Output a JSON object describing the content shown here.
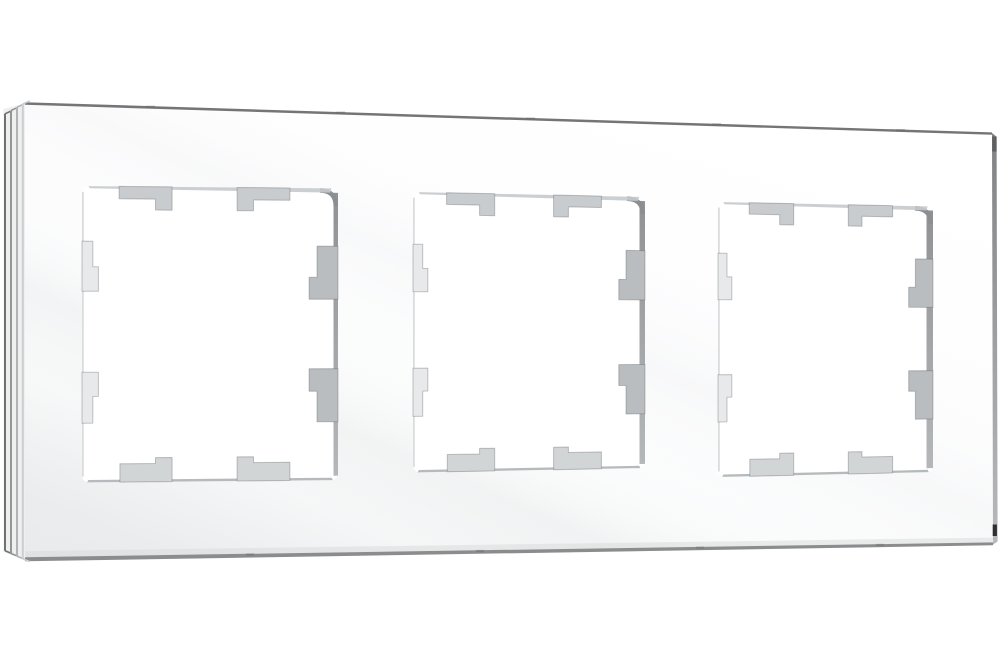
{
  "page": {
    "background": "#ffffff"
  },
  "product": {
    "name": "triple-glass-wall-frame",
    "description": "White glass three-gang wall frame for switches/sockets, shown at a slight left-facing angle on a plain white background",
    "opening_count": 3,
    "openings": [
      {
        "label": "module-opening-1"
      },
      {
        "label": "module-opening-2"
      },
      {
        "label": "module-opening-3"
      }
    ]
  },
  "colors": {
    "background": "#ffffff",
    "surface_bright": "#ffffff",
    "surface_mid": "#fafbfb",
    "surface_shaded": "#f2f3f4",
    "top_edge_line": "#737577",
    "bottom_edge_line": "#8a8c8e",
    "edge_step_1": "#6f7173",
    "edge_step_2": "#939597",
    "edge_step_3": "#b1b3b5",
    "edge_step_4": "#cccecf",
    "flank_bg": "#eef0f0",
    "right_flank_top": "#808284",
    "right_flank_mid": "#9da0a2",
    "right_flank_bottom": "#b7babc",
    "right_flank_tick_top": "#55575a",
    "right_flank_tick_bottom": "#1f2021",
    "wall_dark": "#898d90",
    "wall_light": "#b0b4b6",
    "corner_arc": "#8c8f92",
    "inner_top_band": "#c7cacc",
    "inner_left_line": "#dadcdd",
    "inner_bottom_line": "#b7babc",
    "tab_top": "#c9ccce",
    "tab_bottom": "#d2d5d6",
    "tab_left": "#e7e9ea",
    "tab_right": "#b9bdbf",
    "tab_outline": "rgba(90,95,100,0.35)",
    "edge_nick": "#6b6d6f",
    "bottom_band": "#d7d9da",
    "hole_fill": "#ffffff"
  }
}
